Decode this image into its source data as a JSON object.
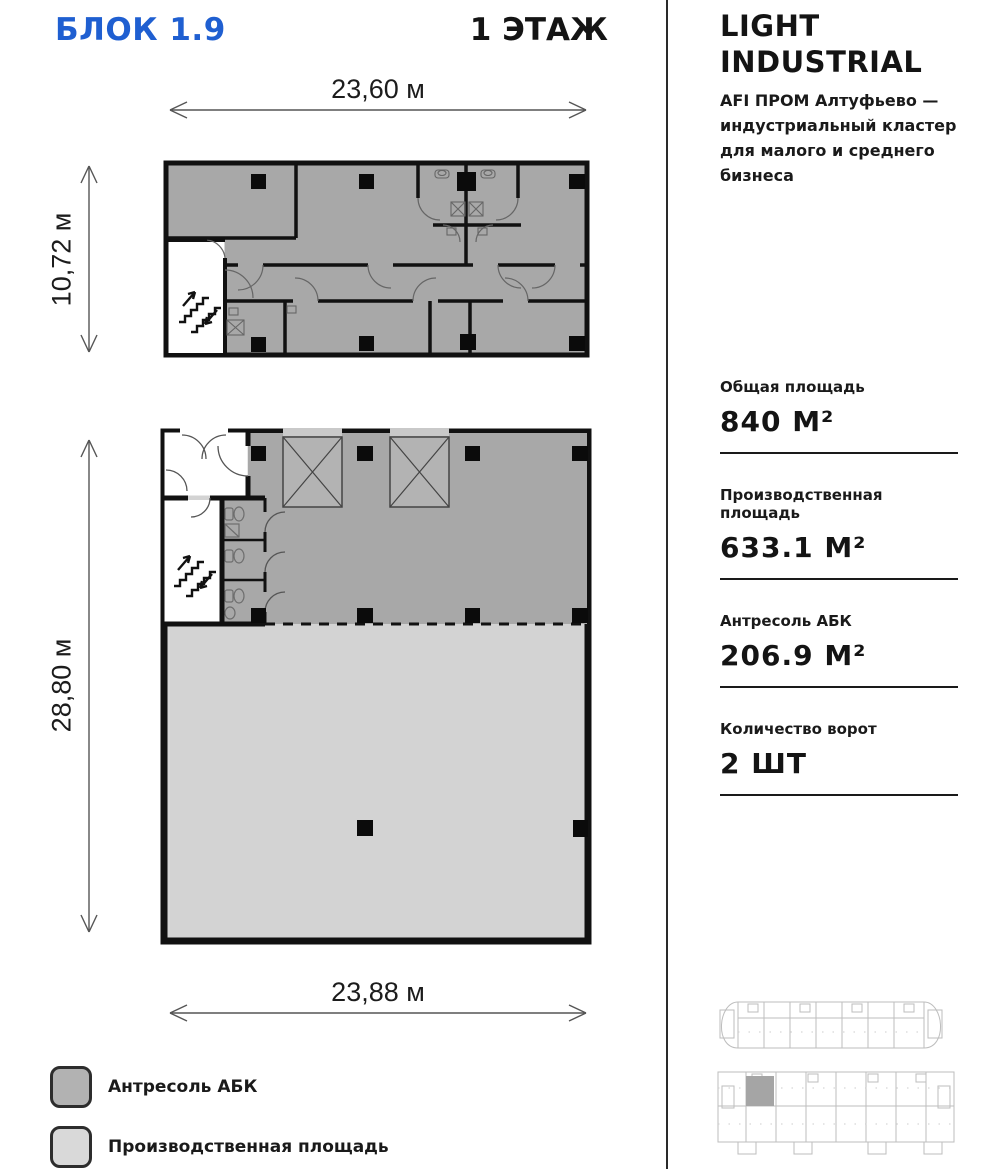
{
  "header": {
    "block_title": "БЛОК 1.9",
    "floor_title": "1 ЭТАЖ"
  },
  "info_panel": {
    "brand_title_line1": "LIGHT",
    "brand_title_line2": "INDUSTRIAL",
    "description_line1": "AFI ПРОМ Алтуфьево —",
    "description_line2": "индустриальный кластер",
    "description_line3": "для малого и среднего",
    "description_line4": "бизнеса",
    "stats": [
      {
        "label": "Общая площадь",
        "value": "840 М²"
      },
      {
        "label": "Производственная площадь",
        "value": "633.1 М²"
      },
      {
        "label": "Антресоль АБК",
        "value": "206.9 М²"
      },
      {
        "label": "Количество ворот",
        "value": "2 ШТ"
      }
    ]
  },
  "dimensions": {
    "top_width": "23,60 м",
    "upper_height": "10,72 м",
    "lower_height": "28,80 м",
    "bottom_width": "23,88 м"
  },
  "legend": {
    "items": [
      {
        "label": "Антресоль АБК",
        "color": "#b2b2b2"
      },
      {
        "label": "Производственная площадь",
        "color": "#d9d9d9"
      }
    ]
  },
  "colors": {
    "accent_blue": "#1f5fd1",
    "mezzanine_gray": "#a8a8a8",
    "production_gray": "#d3d3d3",
    "wall_black": "#111111"
  }
}
